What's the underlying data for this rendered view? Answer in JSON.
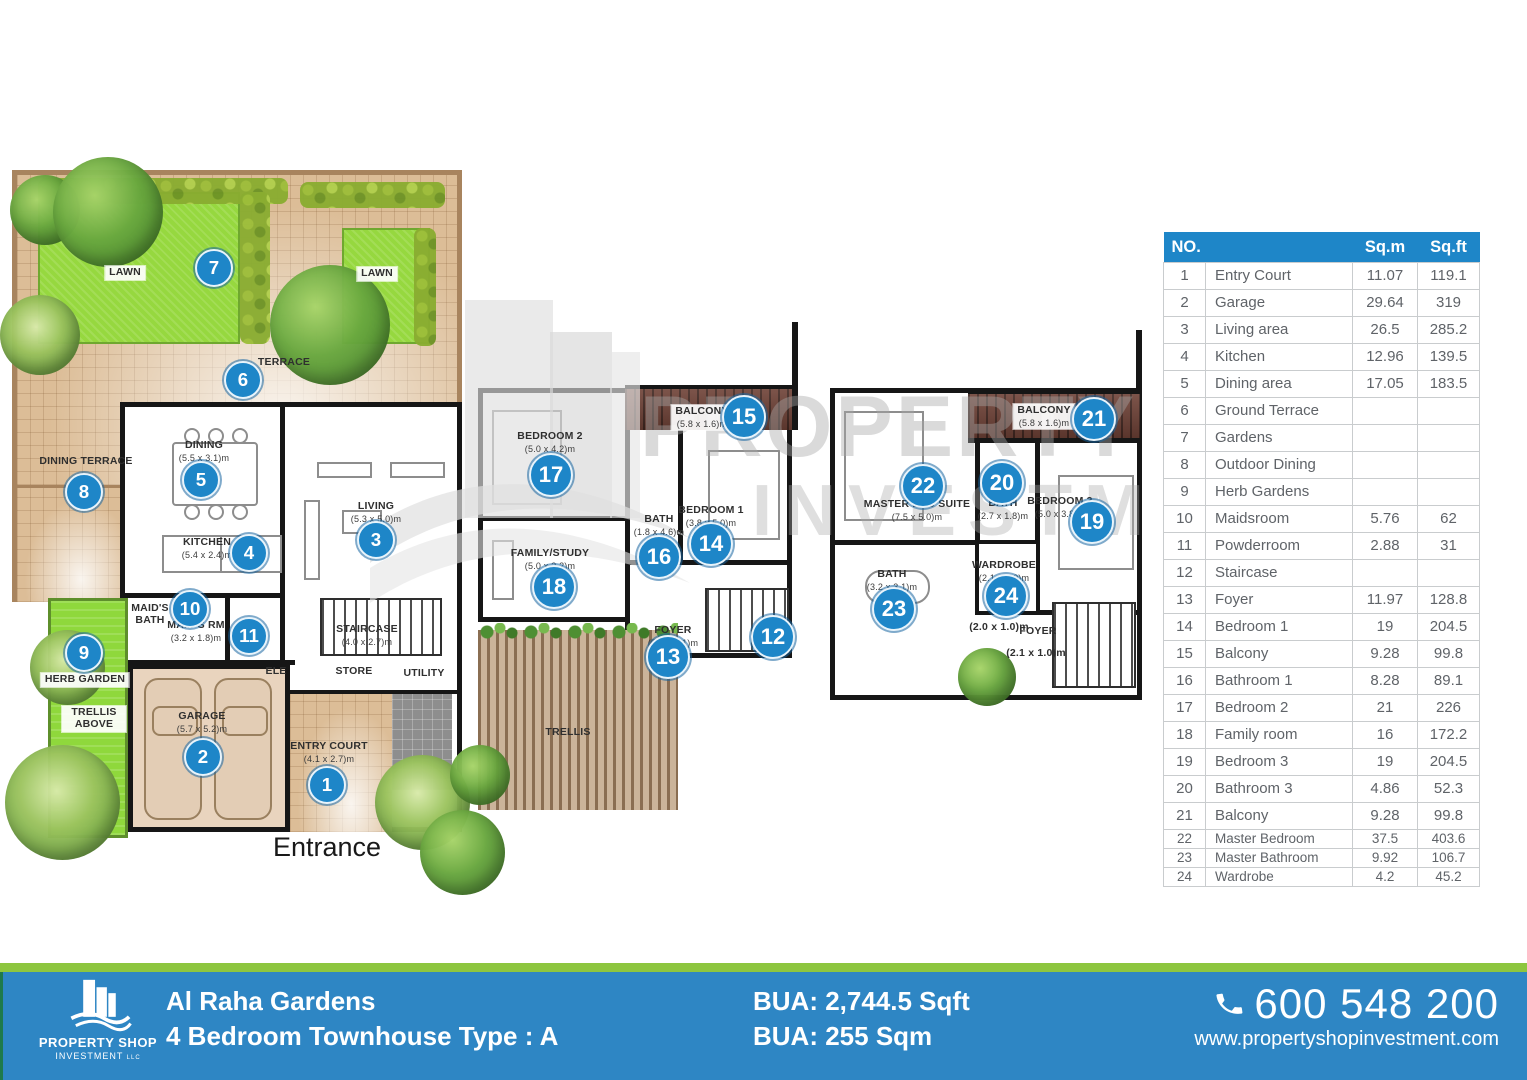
{
  "colors": {
    "accent_blue": "#1E86C8",
    "footer_blue": "#2E86C4",
    "stripe_green": "#8DC63F",
    "lawn_green": "#96D83F",
    "balcony_wood": "#6E4136"
  },
  "watermark": {
    "line1": "PROPERTY SHOP",
    "line2": "INVESTMENT",
    "line3": "LLC"
  },
  "plans": {
    "entrance_label": "Entrance",
    "labels": [
      {
        "t": "LAWN",
        "x": 125,
        "y": 266,
        "chip": true
      },
      {
        "t": "LAWN",
        "x": 377,
        "y": 267,
        "chip": true
      },
      {
        "t": "TERRACE",
        "x": 284,
        "y": 357
      },
      {
        "t": "DINING TERRACE",
        "x": 86,
        "y": 456
      },
      {
        "t": "DINING",
        "d": "(5.5 x 3.1)m",
        "x": 204,
        "y": 440
      },
      {
        "t": "LIVING",
        "d": "(5.3 x 5.0)m",
        "x": 376,
        "y": 501
      },
      {
        "t": "KITCHEN",
        "d": "(5.4 x 2.4)m",
        "x": 207,
        "y": 537
      },
      {
        "t": "MAID'S BATH",
        "x": 150,
        "y": 603,
        "narrow": true
      },
      {
        "t": "MAID'S RM",
        "d": "(3.2 x 1.8)m",
        "x": 196,
        "y": 620
      },
      {
        "t": "STAIRCASE",
        "d": "(4.0 x 2.7)m",
        "x": 367,
        "y": 624
      },
      {
        "t": "ELE",
        "x": 276,
        "y": 666
      },
      {
        "t": "STORE",
        "x": 354,
        "y": 666
      },
      {
        "t": "UTILITY",
        "x": 424,
        "y": 668
      },
      {
        "t": "GARAGE",
        "d": "(5.7 x 5.2)m",
        "x": 202,
        "y": 711
      },
      {
        "t": "ENTRY COURT",
        "d": "(4.1 x 2.7)m",
        "x": 329,
        "y": 741
      },
      {
        "t": "HERB GARDEN",
        "x": 85,
        "y": 673,
        "chip": true
      },
      {
        "t": "TRELLIS ABOVE",
        "x": 94,
        "y": 706,
        "chip": true,
        "narrow": true
      },
      {
        "t": "BEDROOM 2",
        "d": "(5.0 x 4.2)m",
        "x": 550,
        "y": 431
      },
      {
        "t": "BALCONY",
        "d": "(5.8 x 1.6)m",
        "x": 702,
        "y": 405,
        "chip": true
      },
      {
        "t": "BATH",
        "d": "(1.8 x 4.6)m",
        "x": 659,
        "y": 514
      },
      {
        "t": "BEDROOM 1",
        "d": "(3.8 x 5.0)m",
        "x": 711,
        "y": 505
      },
      {
        "t": "FAMILY/STUDY",
        "d": "(5.0 x 3.2)m",
        "x": 550,
        "y": 548
      },
      {
        "t": "FOYER",
        "d": "(5.7 x 2.1)m",
        "x": 673,
        "y": 625
      },
      {
        "t": "TRELLIS",
        "x": 568,
        "y": 727
      },
      {
        "t": "BALCONY",
        "d": "(5.8 x 1.6)m",
        "x": 1044,
        "y": 404,
        "chip": true
      },
      {
        "t": "MASTER BED SUITE",
        "d": "(7.5 x 5.0)m",
        "x": 917,
        "y": 499
      },
      {
        "t": "BATH",
        "d": "(2.7 x 1.8)m",
        "x": 1003,
        "y": 498
      },
      {
        "t": "BEDROOM 3",
        "d": "(5.0 x 3.8)m",
        "x": 1060,
        "y": 496
      },
      {
        "t": "BATH",
        "d": "(3.2 x 3.1)m",
        "x": 892,
        "y": 569
      },
      {
        "t": "WARDROBE",
        "d": "(2.1 x 2.0)m",
        "x": 1004,
        "y": 560
      },
      {
        "t": "(2.0 x 1.0)m",
        "x": 999,
        "y": 622
      },
      {
        "t": "FOYER",
        "x": 1038,
        "y": 626
      },
      {
        "t": "(2.1 x 1.0)m",
        "x": 1036,
        "y": 648
      }
    ],
    "markers": [
      {
        "n": 1,
        "x": 327,
        "y": 785
      },
      {
        "n": 2,
        "x": 203,
        "y": 757
      },
      {
        "n": 3,
        "x": 376,
        "y": 540
      },
      {
        "n": 4,
        "x": 249,
        "y": 553
      },
      {
        "n": 5,
        "x": 201,
        "y": 480
      },
      {
        "n": 6,
        "x": 243,
        "y": 380
      },
      {
        "n": 7,
        "x": 214,
        "y": 268
      },
      {
        "n": 8,
        "x": 84,
        "y": 492
      },
      {
        "n": 9,
        "x": 84,
        "y": 653
      },
      {
        "n": 10,
        "x": 190,
        "y": 609
      },
      {
        "n": 11,
        "x": 249,
        "y": 636
      },
      {
        "n": 12,
        "x": 773,
        "y": 637
      },
      {
        "n": 13,
        "x": 668,
        "y": 657
      },
      {
        "n": 14,
        "x": 711,
        "y": 544
      },
      {
        "n": 15,
        "x": 744,
        "y": 417
      },
      {
        "n": 16,
        "x": 659,
        "y": 557
      },
      {
        "n": 17,
        "x": 551,
        "y": 475
      },
      {
        "n": 18,
        "x": 554,
        "y": 587
      },
      {
        "n": 19,
        "x": 1092,
        "y": 522
      },
      {
        "n": 20,
        "x": 1002,
        "y": 483
      },
      {
        "n": 21,
        "x": 1094,
        "y": 419
      },
      {
        "n": 22,
        "x": 923,
        "y": 486
      },
      {
        "n": 23,
        "x": 894,
        "y": 609
      },
      {
        "n": 24,
        "x": 1006,
        "y": 596
      }
    ]
  },
  "table": {
    "headers": {
      "no": "NO.",
      "sqm": "Sq.m",
      "sqft": "Sq.ft"
    },
    "rows": [
      [
        "1",
        "Entry Court",
        "11.07",
        "119.1"
      ],
      [
        "2",
        "Garage",
        "29.64",
        "319"
      ],
      [
        "3",
        "Living area",
        "26.5",
        "285.2"
      ],
      [
        "4",
        "Kitchen",
        "12.96",
        "139.5"
      ],
      [
        "5",
        "Dining area",
        "17.05",
        "183.5"
      ],
      [
        "6",
        "Ground Terrace",
        "",
        ""
      ],
      [
        "7",
        "Gardens",
        "",
        ""
      ],
      [
        "8",
        "Outdoor Dining",
        "",
        ""
      ],
      [
        "9",
        "Herb Gardens",
        "",
        ""
      ],
      [
        "10",
        "Maidsroom",
        "5.76",
        "62"
      ],
      [
        "11",
        "Powderroom",
        "2.88",
        "31"
      ],
      [
        "12",
        "Staircase",
        "",
        ""
      ],
      [
        "13",
        "Foyer",
        "11.97",
        "128.8"
      ],
      [
        "14",
        "Bedroom 1",
        "19",
        "204.5"
      ],
      [
        "15",
        "Balcony",
        "9.28",
        "99.8"
      ],
      [
        "16",
        "Bathroom 1",
        "8.28",
        "89.1"
      ],
      [
        "17",
        "Bedroom 2",
        "21",
        "226"
      ],
      [
        "18",
        "Family room",
        "16",
        "172.2"
      ],
      [
        "19",
        "Bedroom 3",
        "19",
        "204.5"
      ],
      [
        "20",
        "Bathroom 3",
        "4.86",
        "52.3"
      ],
      [
        "21",
        "Balcony",
        "9.28",
        "99.8"
      ],
      [
        "22",
        "Master Bedroom",
        "37.5",
        "403.6"
      ],
      [
        "23",
        "Master Bathroom",
        "9.92",
        "106.7"
      ],
      [
        "24",
        "Wardrobe",
        "4.2",
        "45.2"
      ]
    ]
  },
  "footer": {
    "logo_line1": "PROPERTY SHOP",
    "logo_line2": "INVESTMENT",
    "logo_suffix": "LLC",
    "project": "Al Raha Gardens",
    "subtitle": "4 Bedroom Townhouse Type : A",
    "bua_sqft": "BUA: 2,744.5 Sqft",
    "bua_sqm": "BUA: 255 Sqm",
    "phone": "600 548 200",
    "phone_icon": "phone-handset",
    "website": "www.propertyshopinvestment.com"
  }
}
